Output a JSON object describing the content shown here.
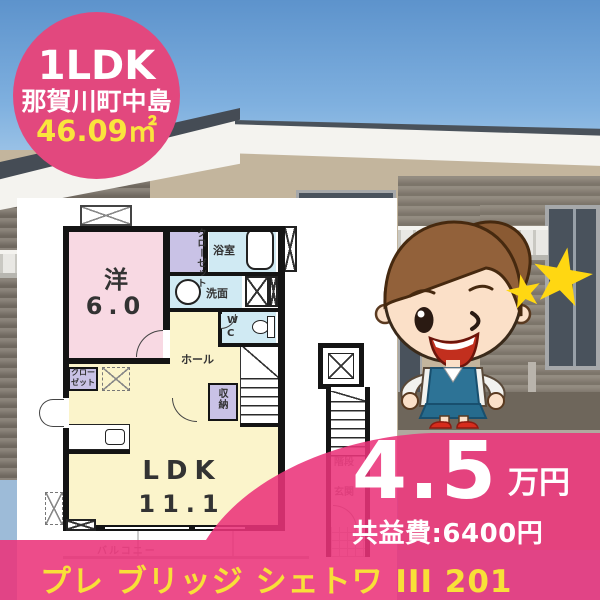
{
  "badge": {
    "layout": "1LDK",
    "location": "那賀川町中島",
    "area": "46.09㎡"
  },
  "floorplan": {
    "labels": {
      "western_room": "洋",
      "western_size": "6.0",
      "closet_upper": "クローゼット",
      "bathroom": "浴室",
      "washroom": "洗面",
      "wc_line1": "W",
      "wc_line2": "C",
      "hall": "ホール",
      "storage": "収納",
      "closet_lower": "クローゼット",
      "ldk": "LDK",
      "ldk_size": "11.1",
      "balcony": "バルコニー",
      "stairs": "階段",
      "entrance": "玄関"
    }
  },
  "price": {
    "rent": "4.5",
    "unit": "万円",
    "common_fee": "共益費:6400円"
  },
  "footer": {
    "building_name": "プレ ブリッジ シェトワ III 201"
  },
  "colors": {
    "accent_pink": "#E2487E",
    "overlay_pink": "#EA337A",
    "text_yellow": "#F8E038",
    "star_yellow": "#FFD712",
    "room_pink": "#F8D9E3",
    "room_yellow": "#FBF4CB",
    "room_blue": "#D0EAF3",
    "room_purple": "#C9C2E6",
    "wall_black": "#141414"
  }
}
